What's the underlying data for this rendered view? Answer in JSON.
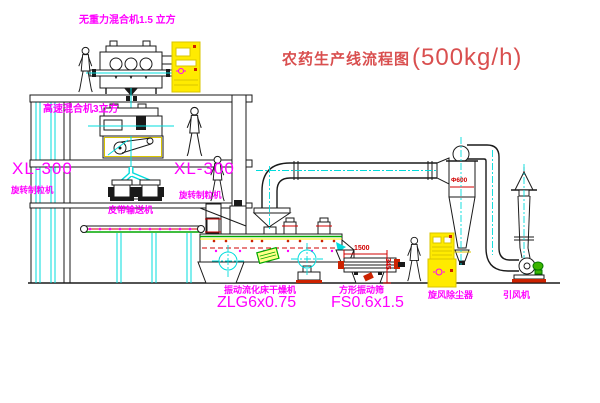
{
  "title": {
    "text": "农药生产线流程图",
    "capacity": "(500kg/h)"
  },
  "labels": {
    "gravity_mixer": "无重力混合机1.5 立方",
    "high_speed_mixer": "高速混合机3立方",
    "granulator_left_model": "XL-300",
    "granulator_left_name": "旋转制粒机",
    "granulator_right_model": "XL-300",
    "granulator_right_name": "旋转制粒机",
    "belt_conveyor": "皮带输送机",
    "dryer_name": "振动流化床干燥机",
    "dryer_model": "ZLG6x0.75",
    "sieve_name": "方形振动筛",
    "sieve_model": "FS0.6x1.5",
    "cyclone": "旋风除尘器",
    "fan": "引风机"
  },
  "dimensions": {
    "sieve_length": "1500",
    "sieve_height": "345",
    "cyclone_diameter": "Φ600"
  },
  "colors": {
    "label_magenta": "#ff00ff",
    "title_red": "#d94f4f",
    "dimension_red": "#d00000",
    "centerline_cyan": "#00dcdc",
    "cabinet_yellow": "#ffeb00",
    "machine_green": "#00a800",
    "line_black": "#1a1a1a"
  },
  "figures": {
    "worker_count": "4"
  }
}
